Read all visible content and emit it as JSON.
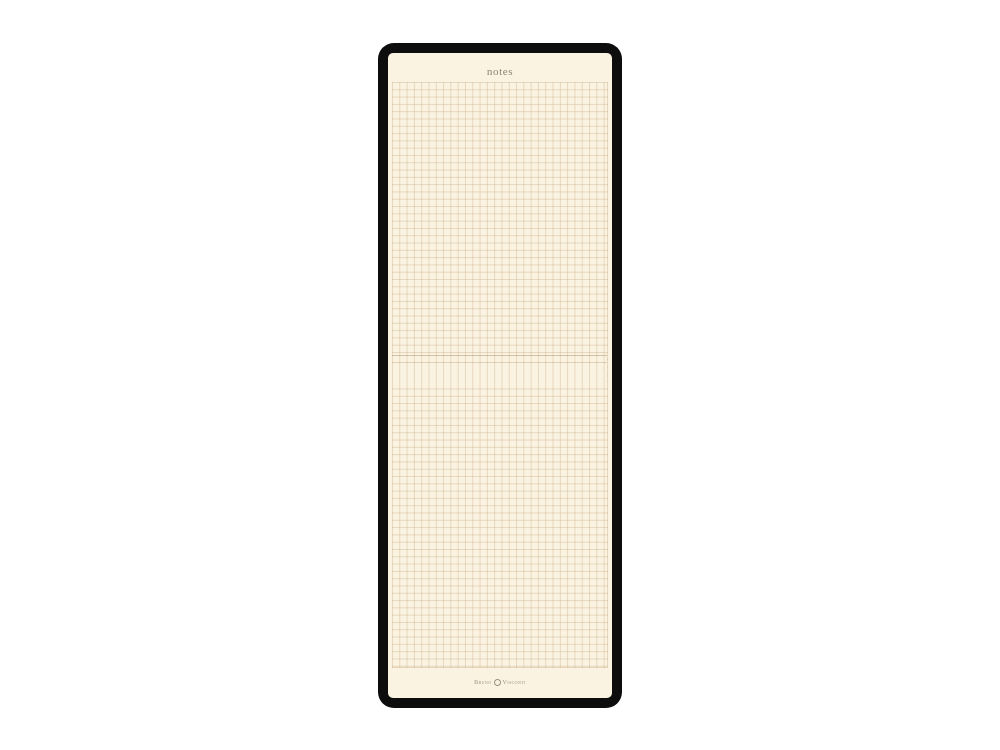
{
  "page": {
    "background_color": "#ffffff"
  },
  "notepad": {
    "frame_color": "#0d0d0d",
    "paper_color": "#fbf3e2",
    "grid_line_color": "#e6d7ba",
    "header": {
      "title": "notes",
      "title_color": "#8b8274"
    },
    "brand": {
      "name_left": "Bruno",
      "name_right": "Visconti",
      "emblem_icon": "bv-crest-icon",
      "text_color": "#9a8e7c"
    }
  }
}
